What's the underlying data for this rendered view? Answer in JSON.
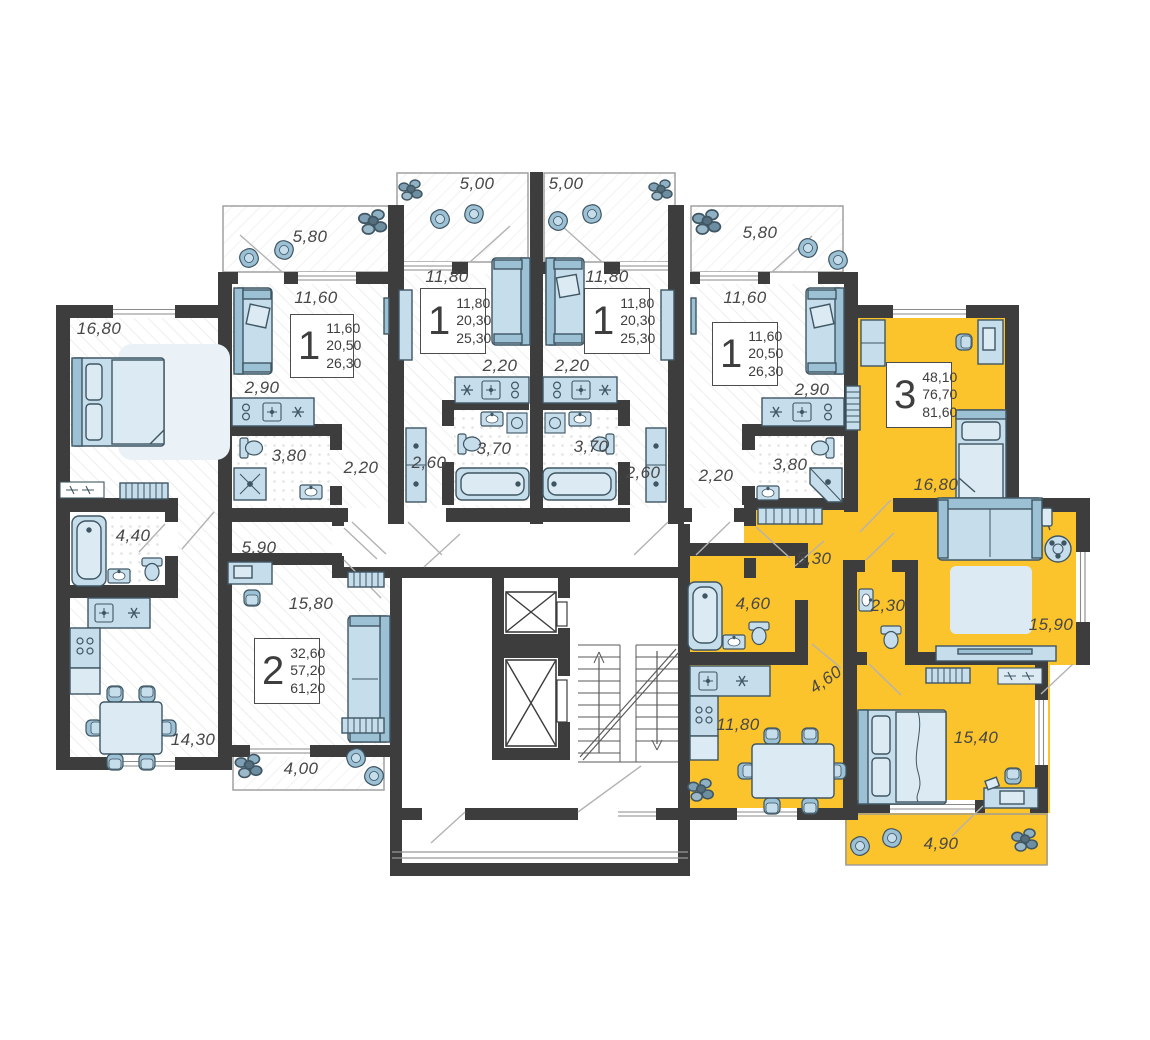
{
  "floor_plan": {
    "colors": {
      "wall": "#3d3d3d",
      "highlight": "#fbc32c",
      "furniture_fill": "#c6ddeb",
      "furniture_light": "#dcebf3",
      "furniture_accent": "#9cc0d4",
      "furniture_stroke": "#3f5663",
      "label_text": "#474747"
    },
    "apartments": [
      {
        "key": "studio-a",
        "type": "1",
        "stats": [
          "11,60",
          "20,50",
          "26,30"
        ],
        "rooms": [
          {
            "name": "balcony",
            "area": "5,80"
          },
          {
            "name": "living",
            "area": "11,60"
          },
          {
            "name": "kitchen",
            "area": "2,90"
          },
          {
            "name": "bathroom",
            "area": "3,80"
          },
          {
            "name": "hall",
            "area": "2,20"
          }
        ]
      },
      {
        "key": "studio-b",
        "type": "1",
        "stats": [
          "11,80",
          "20,30",
          "25,30"
        ],
        "rooms": [
          {
            "name": "balcony",
            "area": "5,00"
          },
          {
            "name": "living",
            "area": "11,80"
          },
          {
            "name": "kitchen",
            "area": "2,20"
          },
          {
            "name": "bathroom",
            "area": "3,70"
          },
          {
            "name": "hall",
            "area": "2,60"
          }
        ]
      },
      {
        "key": "studio-c",
        "type": "1",
        "stats": [
          "11,80",
          "20,30",
          "25,30"
        ],
        "rooms": [
          {
            "name": "balcony",
            "area": "5,00"
          },
          {
            "name": "living",
            "area": "11,80"
          },
          {
            "name": "kitchen",
            "area": "2,20"
          },
          {
            "name": "bathroom",
            "area": "3,70"
          },
          {
            "name": "hall",
            "area": "2,60"
          }
        ]
      },
      {
        "key": "studio-d",
        "type": "1",
        "stats": [
          "11,60",
          "20,50",
          "26,30"
        ],
        "rooms": [
          {
            "name": "balcony",
            "area": "5,80"
          },
          {
            "name": "living",
            "area": "11,60"
          },
          {
            "name": "kitchen",
            "area": "2,90"
          },
          {
            "name": "bathroom",
            "area": "3,80"
          },
          {
            "name": "hall",
            "area": "2,20"
          }
        ]
      },
      {
        "key": "apt-2",
        "type": "2",
        "stats": [
          "32,60",
          "57,20",
          "61,20"
        ],
        "rooms": [
          {
            "name": "bedroom",
            "area": "16,80"
          },
          {
            "name": "bathroom",
            "area": "4,40"
          },
          {
            "name": "hall",
            "area": "5,90"
          },
          {
            "name": "room",
            "area": "15,80"
          },
          {
            "name": "kitchen-living",
            "area": "14,30"
          },
          {
            "name": "balcony",
            "area": "4,00"
          }
        ]
      },
      {
        "key": "apt-3",
        "type": "3",
        "stats": [
          "48,10",
          "76,70",
          "81,60"
        ],
        "rooms": [
          {
            "name": "bedroom",
            "area": "16,80"
          },
          {
            "name": "hall",
            "area": "5,30"
          },
          {
            "name": "bathroom",
            "area": "4,60"
          },
          {
            "name": "wc",
            "area": "2,30"
          },
          {
            "name": "living",
            "area": "15,90"
          },
          {
            "name": "corridor",
            "area": "4,60"
          },
          {
            "name": "kitchen",
            "area": "11,80"
          },
          {
            "name": "bedroom-2",
            "area": "15,40"
          },
          {
            "name": "balcony",
            "area": "4,90"
          }
        ]
      }
    ]
  }
}
